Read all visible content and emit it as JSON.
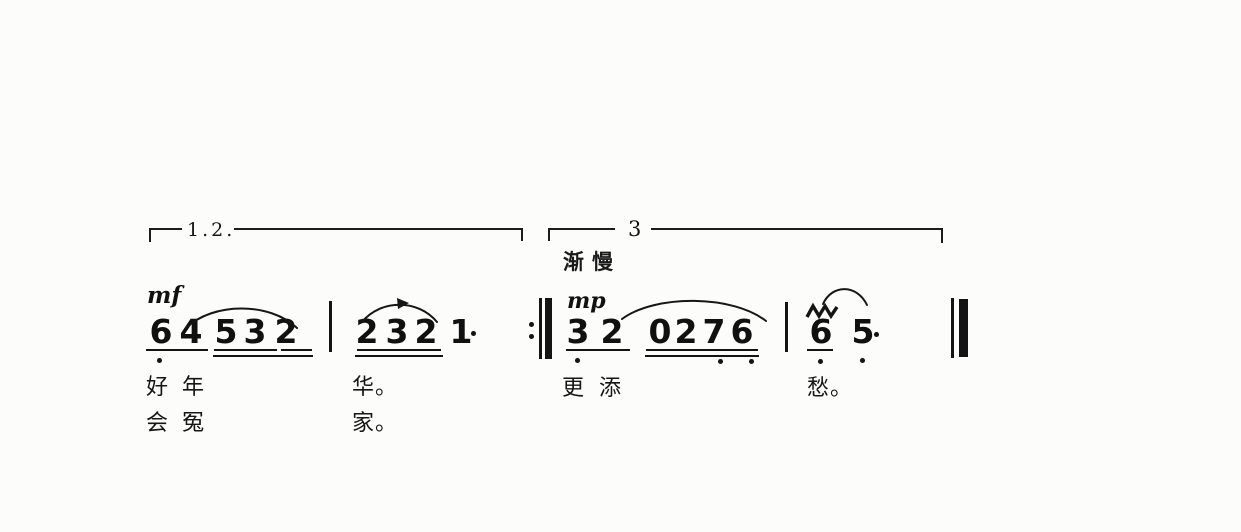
{
  "score_meta": {
    "volta_first_label": "1.2.",
    "volta_second_label": "3",
    "tempo_text": "渐慢",
    "dynamic_1": "mf",
    "dynamic_2": "mp"
  },
  "measures": {
    "m1": [
      "6",
      "4",
      "5",
      "3",
      "2"
    ],
    "m2": [
      "2",
      "3",
      "2",
      "1"
    ],
    "m3": [
      "3",
      "2",
      "0",
      "2",
      "7",
      "6"
    ],
    "m4": [
      "6",
      "5"
    ]
  },
  "lyrics": {
    "line1": [
      "好",
      "年",
      "华。",
      "更",
      "添",
      "愁。"
    ],
    "line2": [
      "会",
      "冤",
      "家。"
    ]
  }
}
